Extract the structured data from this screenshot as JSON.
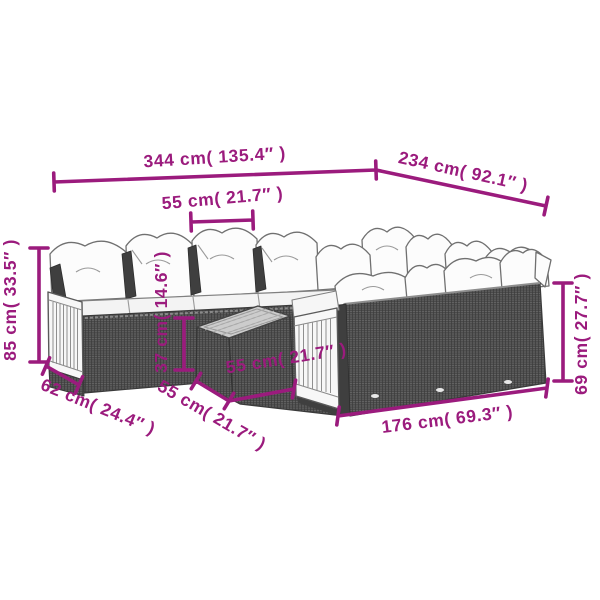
{
  "figure": {
    "type": "product-dimension-diagram",
    "subject": "garden-sofa-set-with-cushions-and-footstool"
  },
  "colors": {
    "dimension_magenta": "#9B1B7D",
    "wicker_dark": "#4a4a4a",
    "wood_white": "#f7f7f7",
    "cushion_white": "#fcfcfc",
    "outline_gray": "#707070",
    "background": "#ffffff"
  },
  "dimensions": {
    "overall_width": {
      "label": "344 cm( 135.4″ )",
      "cm": 344,
      "inches": 135.4
    },
    "overall_depth": {
      "label": "234 cm( 92.1″ )",
      "cm": 234,
      "inches": 92.1
    },
    "seat_module_width": {
      "label": "55 cm( 21.7″ )",
      "cm": 55,
      "inches": 21.7
    },
    "overall_height": {
      "label": "85 cm( 33.5″ )",
      "cm": 85,
      "inches": 33.5
    },
    "backrest_height": {
      "label": "37 cm( 14.6″ )",
      "cm": 37,
      "inches": 14.6
    },
    "arm_depth": {
      "label": "62 cm( 24.4″ )",
      "cm": 62,
      "inches": 24.4
    },
    "stool_depth": {
      "label": "55 cm( 21.7″ )",
      "cm": 55,
      "inches": 21.7
    },
    "stool_width": {
      "label": "55 cm( 21.7″ )",
      "cm": 55,
      "inches": 21.7
    },
    "right_section_width": {
      "label": "176 cm( 69.3″ )",
      "cm": 176,
      "inches": 69.3
    },
    "back_wall_height": {
      "label": "69 cm( 27.7″ )",
      "cm": 69,
      "inches": 27.7
    }
  }
}
